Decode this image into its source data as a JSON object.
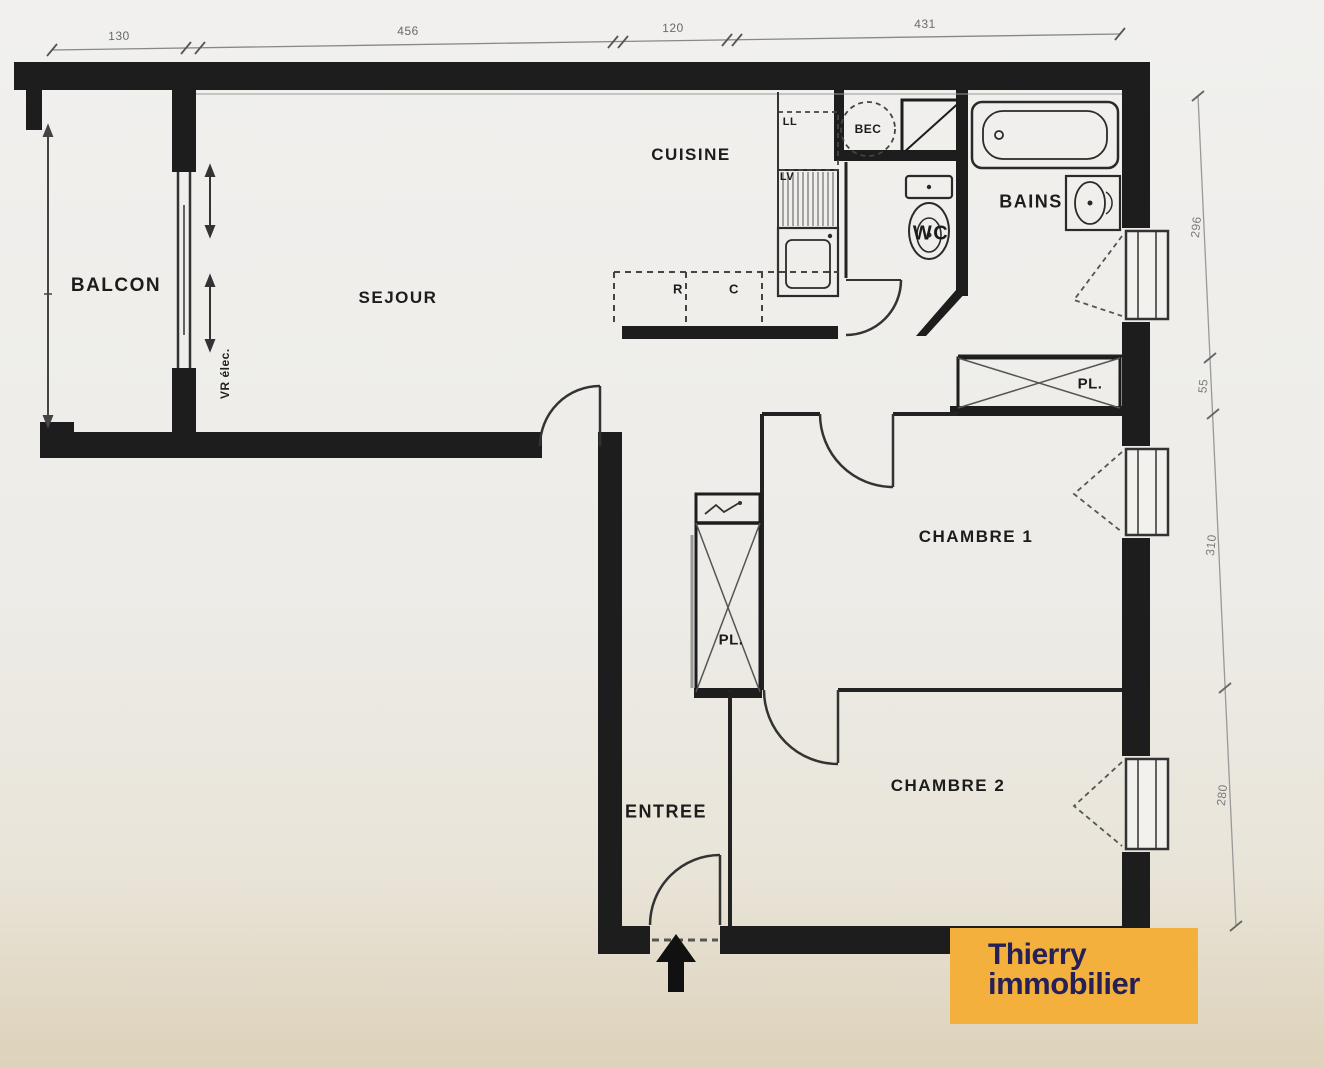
{
  "colors": {
    "wall": "#1d1d1d",
    "line": "#333333",
    "logo_bg": "#F4B03C",
    "logo_text": "#262058",
    "paper": "#EDECE8"
  },
  "labels": {
    "balcon": "BALCON",
    "sejour": "SEJOUR",
    "cuisine": "CUISINE",
    "wc": "WC",
    "bains": "BAINS",
    "chambre1": "CHAMBRE 1",
    "chambre2": "CHAMBRE 2",
    "entree": "ENTREE",
    "placard1": "PL.",
    "placard2": "PL.",
    "ll": "LL",
    "lv": "LV",
    "bec": "BEC",
    "r": "R",
    "c": "C",
    "vr_elec": "VR élec."
  },
  "dimensions": {
    "top": [
      "130",
      "456",
      "120",
      "431"
    ],
    "right": [
      "296",
      "55",
      "310",
      "280"
    ]
  },
  "logo": {
    "line1": "Thierry",
    "line2": "immobilier"
  }
}
